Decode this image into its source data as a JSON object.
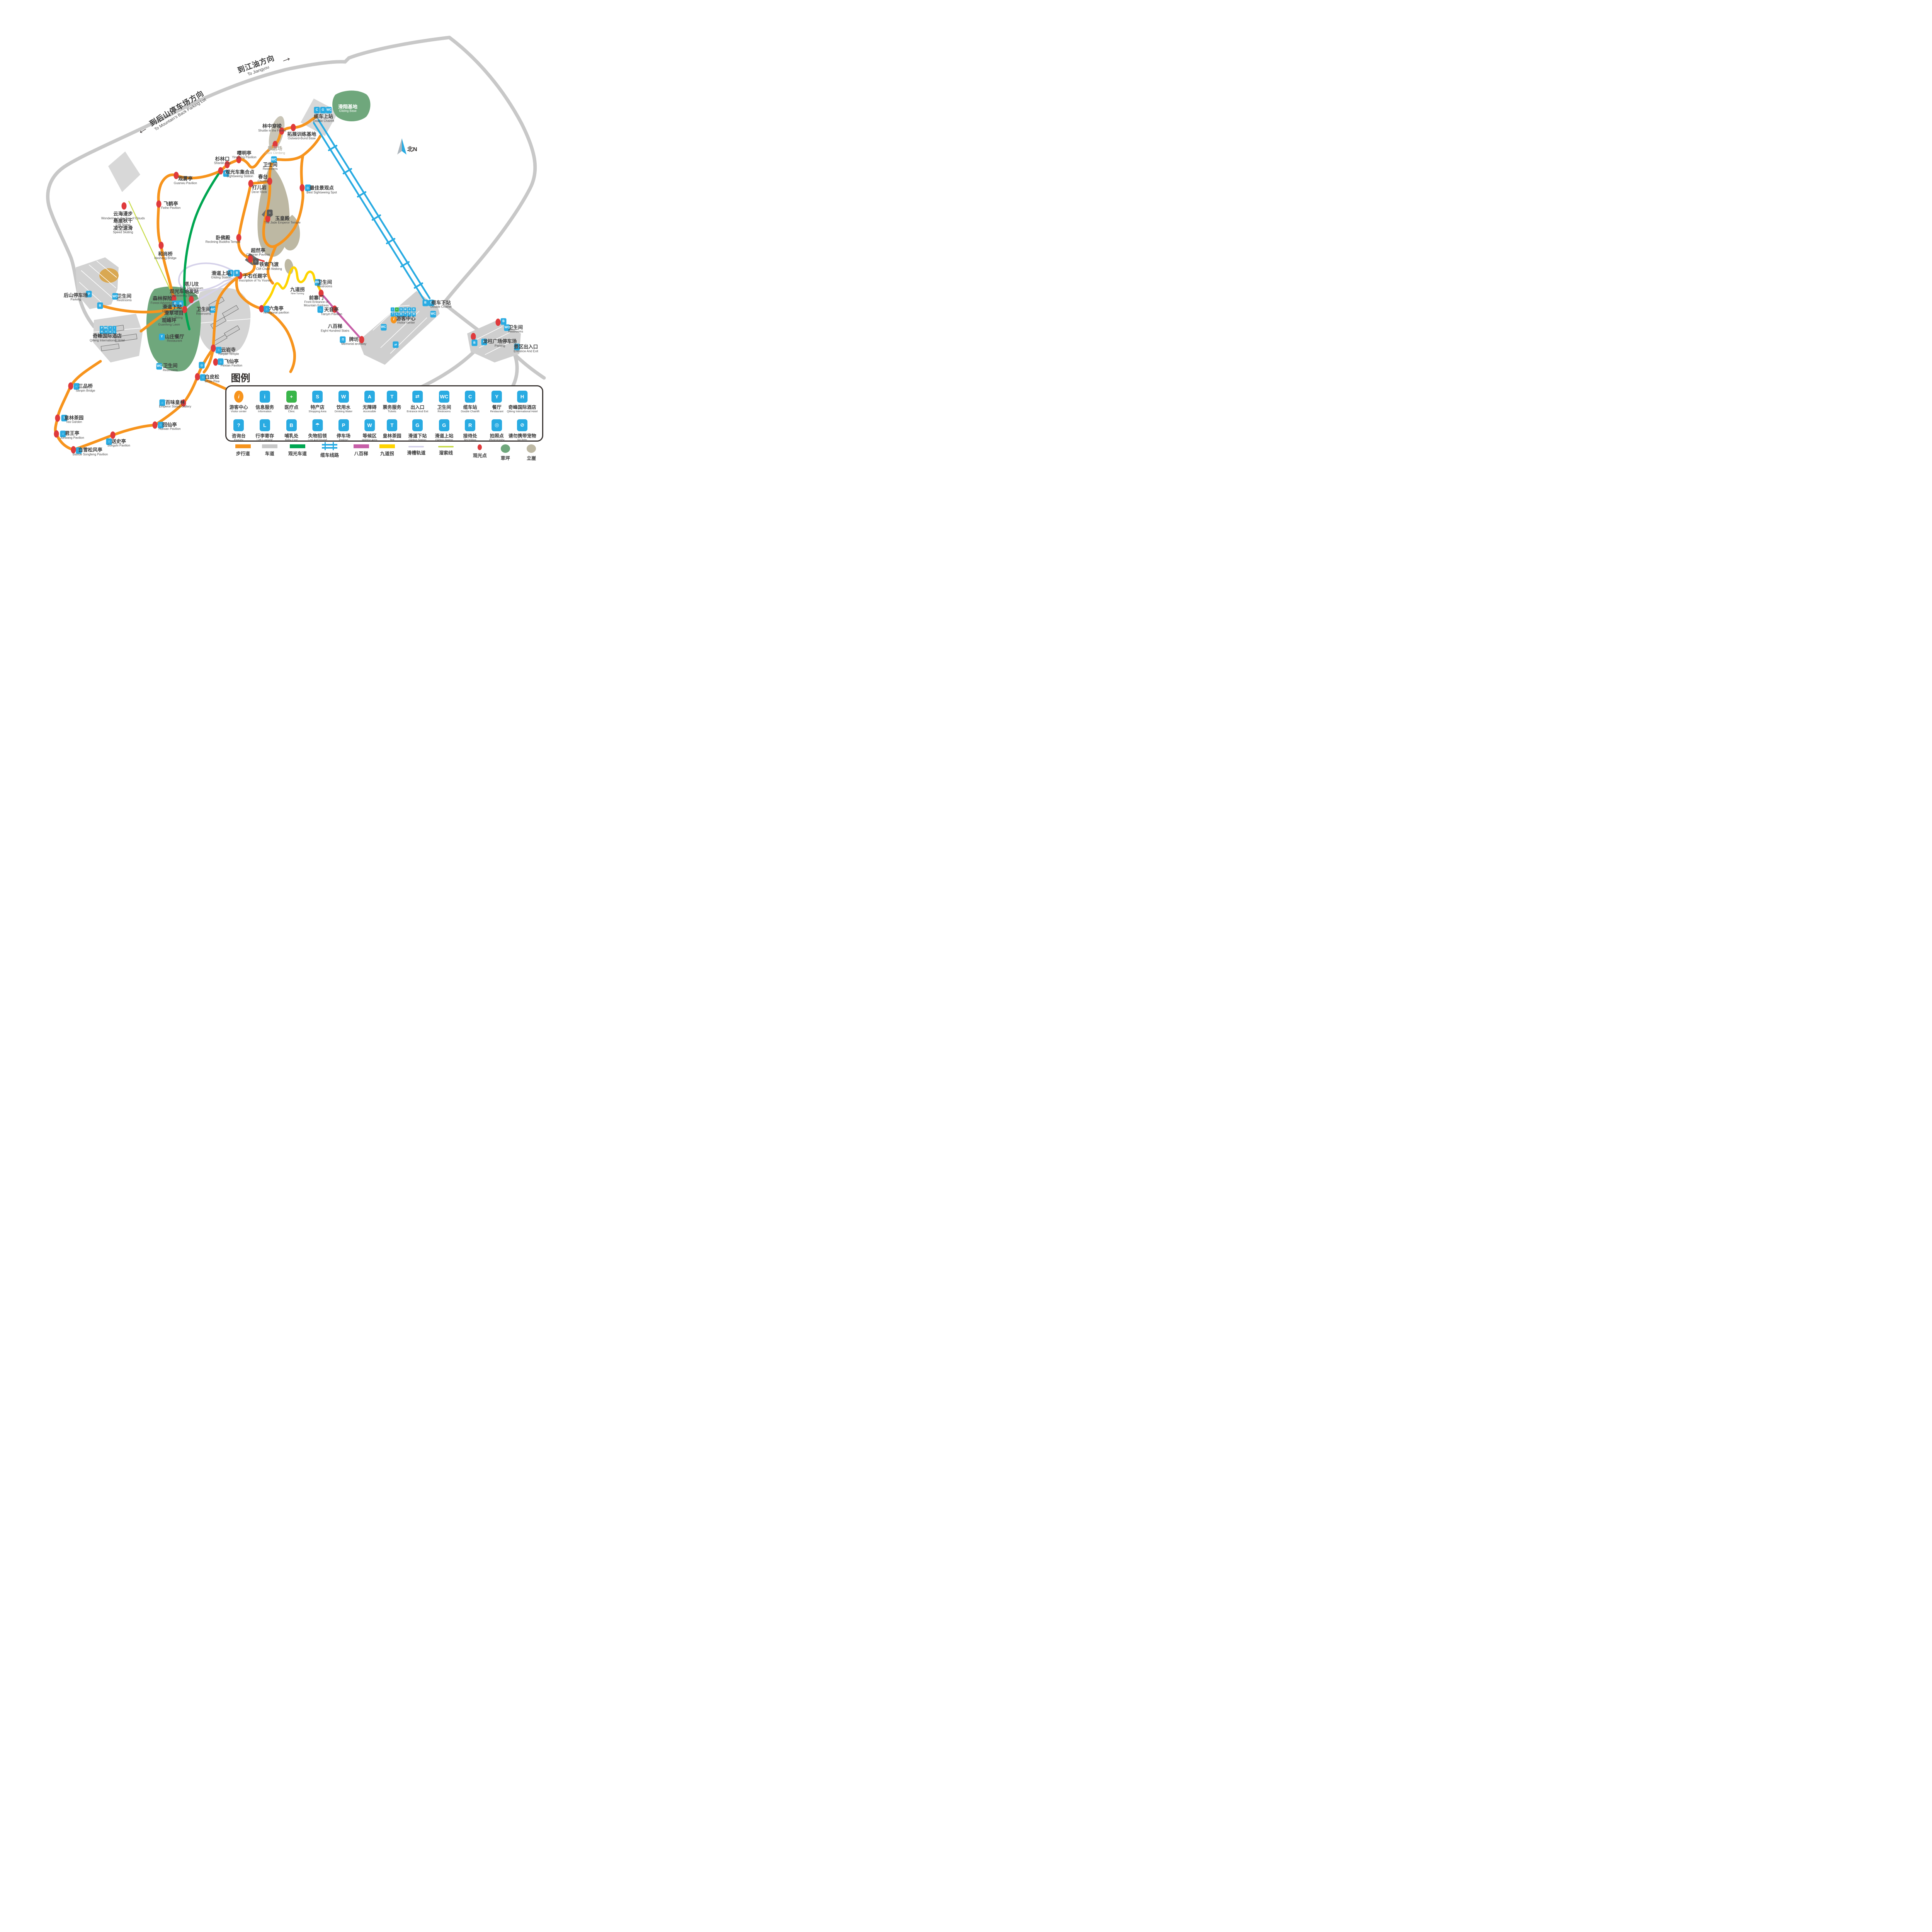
{
  "palette": {
    "trail_orange": "#F7941D",
    "road_gray": "#C8C8C8",
    "sightseeing_green": "#00A651",
    "cable_blue": "#29ABE2",
    "stairs_magenta": "#C75FA8",
    "turning_yellow": "#FFD400",
    "chute_lavender": "#D6D2EA",
    "zipline_yellowgreen": "#C9DC4E",
    "spot_red": "#DF3A3C",
    "lawn_green": "#6FA77C",
    "cliff_khaki": "#BDB8A3",
    "chip_blue": "#29ABE2",
    "clinic_green": "#39B54A",
    "visitor_orange": "#F7941D"
  },
  "arrows": {
    "jiangyou": {
      "zh": "到江油方向",
      "en": "To Jiangyou",
      "glyph": "➔"
    },
    "backlot": {
      "zh": "到后山停车场方向",
      "en": "To Mountain’s Back Parking Lot",
      "glyph": "➔"
    }
  },
  "north": {
    "label": "北N"
  },
  "icon_glyphs": {
    "visitor": "i",
    "info": "i",
    "clinic": "+",
    "shopping": "S",
    "water": "W",
    "accessible": "A",
    "tickets": "T",
    "exit": "⇄",
    "restroom": "WC",
    "chairlift": "C",
    "restaurant": "Y",
    "hotel": "H",
    "enquiry": "?",
    "luggage": "L",
    "baby": "B",
    "lost": "☂",
    "parking": "P",
    "waiting": "W",
    "tea": "T",
    "gliding": "G",
    "gliding2": "G",
    "reception": "R",
    "photo": "◎",
    "nopets": "⊘",
    "bus": "B",
    "camera": "◎",
    "pavilion": "⌂",
    "temple": "⌂",
    "bridge": "∩",
    "memorial": "Π",
    "building": "⌂"
  },
  "legend": {
    "title": "图例",
    "row1": [
      {
        "zh": "游客中心",
        "en": "Visitor center",
        "i": "visitor",
        "cls": "orange",
        "x": 39.4
      },
      {
        "zh": "信息服务",
        "en": "Information",
        "i": "info",
        "x": 43.7
      },
      {
        "zh": "医疗点",
        "en": "Clinic",
        "i": "clinic",
        "cls": "green",
        "x": 48.1
      },
      {
        "zh": "特产店",
        "en": "Shopping Area",
        "i": "shopping",
        "x": 52.4
      },
      {
        "zh": "饮用水",
        "en": "Drinking Water",
        "i": "water",
        "x": 56.7
      },
      {
        "zh": "无障碍",
        "en": "Accessible",
        "i": "accessible",
        "x": 61.0
      },
      {
        "zh": "票务服务",
        "en": "Tickets",
        "i": "tickets",
        "x": 64.7
      },
      {
        "zh": "出入口",
        "en": "Entrance And Exit",
        "i": "exit",
        "x": 68.9
      },
      {
        "zh": "卫生间",
        "en": "Restrooms",
        "i": "restroom",
        "x": 73.3
      },
      {
        "zh": "缆车站",
        "en": "Double Chairlift",
        "i": "chairlift",
        "x": 77.6
      },
      {
        "zh": "餐厅",
        "en": "Restaurant",
        "i": "restaurant",
        "x": 82.0
      },
      {
        "zh": "奇峰国际酒店",
        "en": "Qifeng International Hotel",
        "i": "hotel",
        "x": 86.2
      }
    ],
    "row2": [
      {
        "zh": "咨询台",
        "en": "Enquiry",
        "i": "enquiry",
        "x": 39.4
      },
      {
        "zh": "行李寄存",
        "en": "Left Luggage",
        "i": "luggage",
        "x": 43.7
      },
      {
        "zh": "哺乳处",
        "en": "Baby Care",
        "i": "baby",
        "x": 48.1
      },
      {
        "zh": "失物招领",
        "en": "Lost And Found",
        "i": "lost",
        "x": 52.4
      },
      {
        "zh": "停车场",
        "en": "Parking",
        "i": "parking",
        "x": 56.7
      },
      {
        "zh": "等候区",
        "en": "Waiting Area",
        "i": "waiting",
        "x": 61.0
      },
      {
        "zh": "皇林茶园",
        "en": "Tea",
        "i": "tea",
        "x": 64.7
      },
      {
        "zh": "滑道下站",
        "en": "Gliding Station",
        "i": "gliding",
        "x": 68.9
      },
      {
        "zh": "滑道上站",
        "en": "Gliding Station",
        "i": "gliding2",
        "x": 73.3
      },
      {
        "zh": "接待处",
        "en": "Reception",
        "i": "reception",
        "x": 77.6
      },
      {
        "zh": "拍照点",
        "en": "Photography",
        "i": "photo",
        "x": 82.0
      },
      {
        "zh": "请勿携带宠物",
        "en": "No Pets",
        "i": "nopets",
        "x": 86.2
      }
    ],
    "lines": [
      {
        "zh": "步行道",
        "t": "bar",
        "c": "#F7941D",
        "x": 40.1
      },
      {
        "zh": "车道",
        "t": "bar",
        "c": "#C8C8C8",
        "x": 44.5
      },
      {
        "zh": "观光车道",
        "t": "bar",
        "c": "#00A651",
        "x": 49.1
      },
      {
        "zh": "缆车线路",
        "t": "double",
        "c": "#29ABE2",
        "x": 54.4
      },
      {
        "zh": "八百梯",
        "t": "bar",
        "c": "#C75FA8",
        "x": 59.6
      },
      {
        "zh": "九道拐",
        "t": "bar",
        "c": "#FFD400",
        "x": 63.9
      },
      {
        "zh": "滑槽轨道",
        "t": "thin",
        "c": "#D6D2EA",
        "x": 68.7
      },
      {
        "zh": "溜索线",
        "t": "thin",
        "c": "#C9DC4E",
        "x": 73.6
      },
      {
        "zh": "观光点",
        "t": "dot",
        "c": "#DF3A3C",
        "x": 79.2
      },
      {
        "zh": "草坪",
        "t": "blob",
        "c": "#6FA77C",
        "x": 83.4
      },
      {
        "zh": "立崖",
        "t": "blob",
        "c": "#BDB8A3",
        "x": 87.7
      }
    ]
  },
  "pois": [
    {
      "zh": "滑翔基地",
      "en": "Gliding Base",
      "x": 57.4,
      "y": 22.3,
      "cls": "white"
    },
    {
      "zh": "缆车上站",
      "en": "Double Chairlift",
      "x": 53.4,
      "y": 24.3
    },
    {
      "zh": "拓展训练基地",
      "en": "Outward-Bund Base",
      "x": 49.8,
      "y": 27.9
    },
    {
      "zh": "林中穿梭",
      "en": "Shuttle in the Forest",
      "x": 44.9,
      "y": 26.3
    },
    {
      "zh": "攀岩场",
      "en": "Rock Climbing",
      "x": 45.4,
      "y": 30.9,
      "cls": "gray"
    },
    {
      "zh": "嘤明亭",
      "en": "Yingming Pavilion",
      "x": 40.3,
      "y": 31.8
    },
    {
      "zh": "杉林口",
      "en": "Shanlin Kou",
      "x": 36.7,
      "y": 33.0
    },
    {
      "zh": "观光车集合点",
      "en": "Sightseeing Station",
      "x": 39.6,
      "y": 35.7
    },
    {
      "zh": "卫生间",
      "en": "Restrooms",
      "x": 44.6,
      "y": 34.2
    },
    {
      "zh": "春台",
      "en": "Chuntai",
      "x": 43.4,
      "y": 36.7
    },
    {
      "zh": "打儿岩",
      "en": "Da’er Rock",
      "x": 42.8,
      "y": 38.9
    },
    {
      "zh": "最佳景观点",
      "en": "Best Sightseeing Spot",
      "x": 53.1,
      "y": 39.0
    },
    {
      "zh": "观雾亭",
      "en": "Guanwu Pavilion",
      "x": 30.6,
      "y": 37.1
    },
    {
      "zh": "飞鹤亭",
      "en": "Feihe Pavilion",
      "x": 28.2,
      "y": 42.2
    },
    {
      "zh": "云海漫步",
      "en": "Wondering in the Sea of Clouds",
      "x": 20.3,
      "y": 44.3
    },
    {
      "zh": "悬崖秋千",
      "en": "Cliff Swing",
      "x": 20.3,
      "y": 45.7
    },
    {
      "zh": "凌空速滑",
      "en": "Speed Skating",
      "x": 20.3,
      "y": 47.2
    },
    {
      "zh": "玉皇殿",
      "en": "The Jade Emperor Temple",
      "x": 46.6,
      "y": 45.2
    },
    {
      "zh": "卧佛殿",
      "en": "Reclining Buddha Temple",
      "x": 36.8,
      "y": 49.2
    },
    {
      "zh": "超然亭",
      "en": "Chaoran Pavilion",
      "x": 42.6,
      "y": 51.8
    },
    {
      "zh": "铁索飞渡",
      "en": "Cliff Chain Walking",
      "x": 44.4,
      "y": 54.7
    },
    {
      "zh": "和尚桥",
      "en": "Heshang Bridge",
      "x": 27.3,
      "y": 52.5
    },
    {
      "zh": "滑道上站",
      "en": "Gliding Station",
      "x": 36.5,
      "y": 56.5
    },
    {
      "zh": "于右任题字",
      "en": "Inscription of Yu Youren",
      "x": 42.1,
      "y": 57.1
    },
    {
      "zh": "塔儿坟",
      "en": "Ta’er Mausoleum",
      "x": 31.6,
      "y": 58.7
    },
    {
      "zh": "观光车始发站",
      "en": "Sightseeing Station",
      "x": 30.4,
      "y": 60.2
    },
    {
      "zh": "九道拐",
      "en": "Nine Turning",
      "x": 49.1,
      "y": 59.8,
      "cls": "smen"
    },
    {
      "zh": "卫生间",
      "en": "Restrooms",
      "x": 53.6,
      "y": 58.3
    },
    {
      "zh": "前寨门",
      "en": "Front Entrance of\nMountain Fortress",
      "x": 52.2,
      "y": 61.9
    },
    {
      "zh": "天音亭",
      "en": "Tianyin Pavilion",
      "x": 54.7,
      "y": 64.0
    },
    {
      "zh": "八百梯",
      "en": "Eight Hundred Stairs",
      "x": 55.3,
      "y": 67.4
    },
    {
      "zh": "牌坊",
      "en": "Memorial archway",
      "x": 58.4,
      "y": 70.1
    },
    {
      "zh": "游客中心",
      "en": "Visitor center",
      "x": 67.0,
      "y": 65.8
    },
    {
      "zh": "缆车下站",
      "en": "Double Chairlift",
      "x": 72.8,
      "y": 62.5
    },
    {
      "zh": "六角亭",
      "en": "hexagonal pavilion",
      "x": 45.6,
      "y": 63.7
    },
    {
      "zh": "后山停车场",
      "en": "Parking",
      "x": 12.5,
      "y": 61.0
    },
    {
      "zh": "卫生间",
      "en": "Restrooms",
      "x": 20.5,
      "y": 61.2
    },
    {
      "zh": "森林探险",
      "en": "Forest Adventure",
      "x": 26.8,
      "y": 61.7
    },
    {
      "zh": "滑道下站",
      "en": "Gliding Station",
      "x": 28.4,
      "y": 63.4
    },
    {
      "zh": "滑草项目",
      "en": "Grass Skiing",
      "x": 28.7,
      "y": 64.7
    },
    {
      "zh": "观峰坪",
      "en": "Guanfeng Lawn",
      "x": 27.9,
      "y": 66.2
    },
    {
      "zh": "卫生间",
      "en": "Restrooms",
      "x": 33.6,
      "y": 63.9
    },
    {
      "zh": "奇峰国际酒店",
      "en": "Qifeng International Hotel",
      "x": 17.7,
      "y": 69.4
    },
    {
      "zh": "山庄餐厅",
      "en": "Restaurant",
      "x": 28.8,
      "y": 69.5
    },
    {
      "zh": "云岩寺",
      "en": "Yunyan Temple",
      "x": 37.7,
      "y": 72.2
    },
    {
      "zh": "飞仙亭",
      "en": "Feixian Pavilion",
      "x": 38.2,
      "y": 74.6
    },
    {
      "zh": "卫生间",
      "en": "Restrooms",
      "x": 28.1,
      "y": 75.5
    },
    {
      "zh": "白皮松",
      "en": "White Pine",
      "x": 35.0,
      "y": 77.8
    },
    {
      "zh": "三品桥",
      "en": "Sanpin Bridge",
      "x": 14.1,
      "y": 79.7
    },
    {
      "zh": "百味皇林",
      "en": "Emperor Statue Gallery",
      "x": 28.9,
      "y": 83.0
    },
    {
      "zh": "皇林茶园",
      "en": "Tea Garden",
      "x": 12.2,
      "y": 86.2
    },
    {
      "zh": "回仙亭",
      "en": "Huixian Pavilion",
      "x": 28.0,
      "y": 87.6
    },
    {
      "zh": "君王亭",
      "en": "Junwang Pavilion",
      "x": 11.9,
      "y": 89.4
    },
    {
      "zh": "送史亭",
      "en": "Songshi Pavilion",
      "x": 19.6,
      "y": 91.0
    },
    {
      "zh": "白雪松风亭",
      "en": "Baixue Songfeng Pavilion",
      "x": 14.9,
      "y": 92.8
    },
    {
      "zh": "龙柱广场停车场",
      "en": "Parking",
      "x": 82.5,
      "y": 70.5
    },
    {
      "zh": "卫生间",
      "en": "Restrooms",
      "x": 85.1,
      "y": 67.6
    },
    {
      "zh": "景区出入口",
      "en": "Entrance And Exit",
      "x": 86.8,
      "y": 71.6
    }
  ],
  "dots": [
    [
      48.4,
      26.2
    ],
    [
      46.5,
      26.9
    ],
    [
      45.4,
      29.7
    ],
    [
      39.4,
      32.8
    ],
    [
      37.5,
      33.8
    ],
    [
      36.4,
      35.1
    ],
    [
      29.1,
      36.0
    ],
    [
      26.2,
      41.9
    ],
    [
      20.5,
      42.3
    ],
    [
      26.6,
      50.4
    ],
    [
      39.4,
      48.8
    ],
    [
      44.2,
      44.9
    ],
    [
      41.3,
      53.2
    ],
    [
      44.5,
      37.2
    ],
    [
      41.4,
      37.7
    ],
    [
      49.9,
      38.6
    ],
    [
      39.6,
      56.6
    ],
    [
      28.7,
      61.3
    ],
    [
      31.6,
      61.5
    ],
    [
      30.5,
      63.6
    ],
    [
      35.2,
      71.5
    ],
    [
      35.6,
      74.4
    ],
    [
      32.6,
      77.4
    ],
    [
      43.2,
      63.4
    ],
    [
      53.0,
      60.2
    ],
    [
      55.2,
      63.5
    ],
    [
      59.7,
      69.8
    ],
    [
      11.7,
      79.3
    ],
    [
      9.5,
      85.9
    ],
    [
      9.3,
      89.1
    ],
    [
      18.6,
      89.4
    ],
    [
      12.1,
      92.4
    ],
    [
      25.6,
      87.3
    ],
    [
      30.3,
      82.8
    ],
    [
      78.1,
      69.1
    ],
    [
      82.2,
      66.2
    ]
  ],
  "chips": [
    {
      "i": "chairlift",
      "x": 52.3,
      "y": 22.6
    },
    {
      "i": "gliding",
      "x": 53.3,
      "y": 22.6
    },
    {
      "i": "restroom",
      "x": 54.3,
      "y": 22.6
    },
    {
      "i": "bus",
      "x": 37.3,
      "y": 35.6
    },
    {
      "i": "restroom",
      "x": 45.2,
      "y": 32.8
    },
    {
      "i": "camera",
      "x": 50.8,
      "y": 38.6
    },
    {
      "i": "building",
      "x": 44.5,
      "y": 43.7,
      "cls": "dark"
    },
    {
      "i": "building",
      "x": 42.2,
      "y": 53.7,
      "cls": "dark"
    },
    {
      "i": "gliding2",
      "x": 38.1,
      "y": 56.1
    },
    {
      "i": "bus",
      "x": 39.1,
      "y": 56.1
    },
    {
      "i": "restroom",
      "x": 52.4,
      "y": 58.0
    },
    {
      "i": "pavilion",
      "x": 52.9,
      "y": 63.6
    },
    {
      "i": "memorial",
      "x": 56.6,
      "y": 69.8
    },
    {
      "i": "visitor",
      "x": 65.0,
      "y": 65.6,
      "cls": "orange"
    },
    {
      "i": "info",
      "x": 64.8,
      "y": 63.6,
      "cls": "sm"
    },
    {
      "i": "clinic",
      "x": 65.5,
      "y": 63.6,
      "cls": "sm green"
    },
    {
      "i": "shopping",
      "x": 66.2,
      "y": 63.6,
      "cls": "sm"
    },
    {
      "i": "water",
      "x": 66.9,
      "y": 63.6,
      "cls": "sm"
    },
    {
      "i": "accessible",
      "x": 67.6,
      "y": 63.6,
      "cls": "sm"
    },
    {
      "i": "bus",
      "x": 68.3,
      "y": 63.6,
      "cls": "sm"
    },
    {
      "i": "enquiry",
      "x": 64.8,
      "y": 64.6,
      "cls": "sm"
    },
    {
      "i": "luggage",
      "x": 65.5,
      "y": 64.6,
      "cls": "sm"
    },
    {
      "i": "baby",
      "x": 66.2,
      "y": 64.6,
      "cls": "sm"
    },
    {
      "i": "lost",
      "x": 66.9,
      "y": 64.6,
      "cls": "sm"
    },
    {
      "i": "parking",
      "x": 67.6,
      "y": 64.6,
      "cls": "sm"
    },
    {
      "i": "waiting",
      "x": 68.3,
      "y": 64.6,
      "cls": "sm"
    },
    {
      "i": "bus",
      "x": 70.2,
      "y": 62.2
    },
    {
      "i": "chairlift",
      "x": 71.2,
      "y": 62.2
    },
    {
      "i": "restroom",
      "x": 71.5,
      "y": 64.5
    },
    {
      "i": "restroom",
      "x": 63.3,
      "y": 67.2
    },
    {
      "i": "exit",
      "x": 65.3,
      "y": 70.8
    },
    {
      "i": "pavilion",
      "x": 44.0,
      "y": 63.5
    },
    {
      "i": "parking",
      "x": 14.7,
      "y": 60.4
    },
    {
      "i": "restroom",
      "x": 19.0,
      "y": 60.9
    },
    {
      "i": "bus",
      "x": 16.5,
      "y": 62.8
    },
    {
      "i": "gliding",
      "x": 28.9,
      "y": 62.4
    },
    {
      "i": "bus",
      "x": 29.8,
      "y": 62.4
    },
    {
      "i": "restroom",
      "x": 35.1,
      "y": 63.6
    },
    {
      "i": "parking",
      "x": 16.8,
      "y": 67.4,
      "cls": "sm"
    },
    {
      "i": "restroom",
      "x": 17.5,
      "y": 67.4,
      "cls": "sm"
    },
    {
      "i": "enquiry",
      "x": 18.2,
      "y": 67.4,
      "cls": "sm"
    },
    {
      "i": "info",
      "x": 18.9,
      "y": 67.4,
      "cls": "sm"
    },
    {
      "i": "hotel",
      "x": 16.8,
      "y": 68.2,
      "cls": "sm"
    },
    {
      "i": "restaurant",
      "x": 17.5,
      "y": 68.2,
      "cls": "sm"
    },
    {
      "i": "nopets",
      "x": 18.2,
      "y": 68.2,
      "cls": "sm"
    },
    {
      "i": "luggage",
      "x": 18.9,
      "y": 68.2,
      "cls": "sm"
    },
    {
      "i": "restaurant",
      "x": 26.7,
      "y": 69.2
    },
    {
      "i": "temple",
      "x": 36.1,
      "y": 71.9
    },
    {
      "i": "pavilion",
      "x": 36.4,
      "y": 74.3
    },
    {
      "i": "restroom",
      "x": 26.3,
      "y": 75.2
    },
    {
      "i": "camera",
      "x": 33.3,
      "y": 75.0
    },
    {
      "i": "pavilion",
      "x": 33.5,
      "y": 77.5
    },
    {
      "i": "bridge",
      "x": 12.6,
      "y": 79.4
    },
    {
      "i": "temple",
      "x": 26.8,
      "y": 82.7
    },
    {
      "i": "tea",
      "x": 10.6,
      "y": 85.9
    },
    {
      "i": "pavilion",
      "x": 26.5,
      "y": 87.3
    },
    {
      "i": "pavilion",
      "x": 10.4,
      "y": 89.1
    },
    {
      "i": "pavilion",
      "x": 18.0,
      "y": 90.7
    },
    {
      "i": "pavilion",
      "x": 13.0,
      "y": 92.5
    },
    {
      "i": "parking",
      "x": 79.9,
      "y": 70.2
    },
    {
      "i": "restroom",
      "x": 83.7,
      "y": 67.3
    },
    {
      "i": "exit",
      "x": 85.3,
      "y": 71.3
    },
    {
      "i": "bus",
      "x": 83.1,
      "y": 66.0
    },
    {
      "i": "bus",
      "x": 78.3,
      "y": 70.4
    }
  ]
}
